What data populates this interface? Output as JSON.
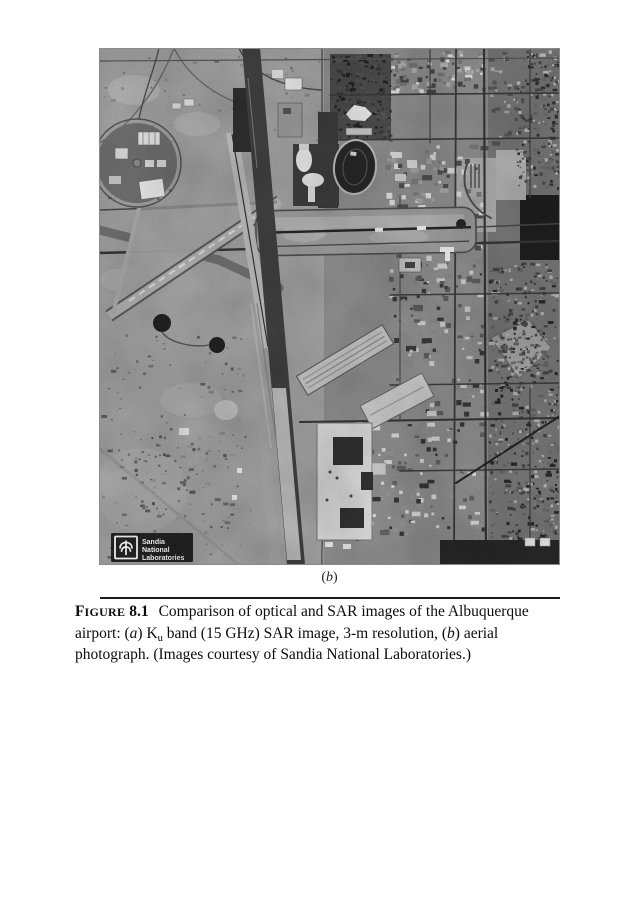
{
  "figure": {
    "photo_description": "aerial-photograph-albuquerque-airport",
    "sublabel": {
      "open": "(",
      "letter": "b",
      "close": ")"
    },
    "logo": {
      "line1": "Sandia",
      "line2": "National",
      "line3": "Laboratories"
    }
  },
  "caption": {
    "figure_initial": "F",
    "figure_rest": "IGURE",
    "figure_number": "8.1",
    "line1_text": "Comparison of optical and SAR images of the Albuquerque",
    "line2": {
      "pre": "airport: (",
      "a_italic": "a",
      "mid1": ") K",
      "sub_u": "u",
      "mid2": " band (15 GHz) SAR image, 3-m resolution, (",
      "b_italic": "b",
      "post": ") aerial"
    },
    "line3_text": "photograph. (Images courtesy of Sandia National Laboratories.)"
  },
  "colors": {
    "page_background": "#ffffff",
    "photo_base": "#a4a4a4",
    "city_base": "#8f8f8f",
    "residential_base": "#787878",
    "runway_dark": "#3f3f3f",
    "apron_light": "#c0c0c0",
    "logo_background": "#161616",
    "logo_text": "#ffffff",
    "rule": "#1b1b1b",
    "caption_text": "#0d0d0d"
  }
}
